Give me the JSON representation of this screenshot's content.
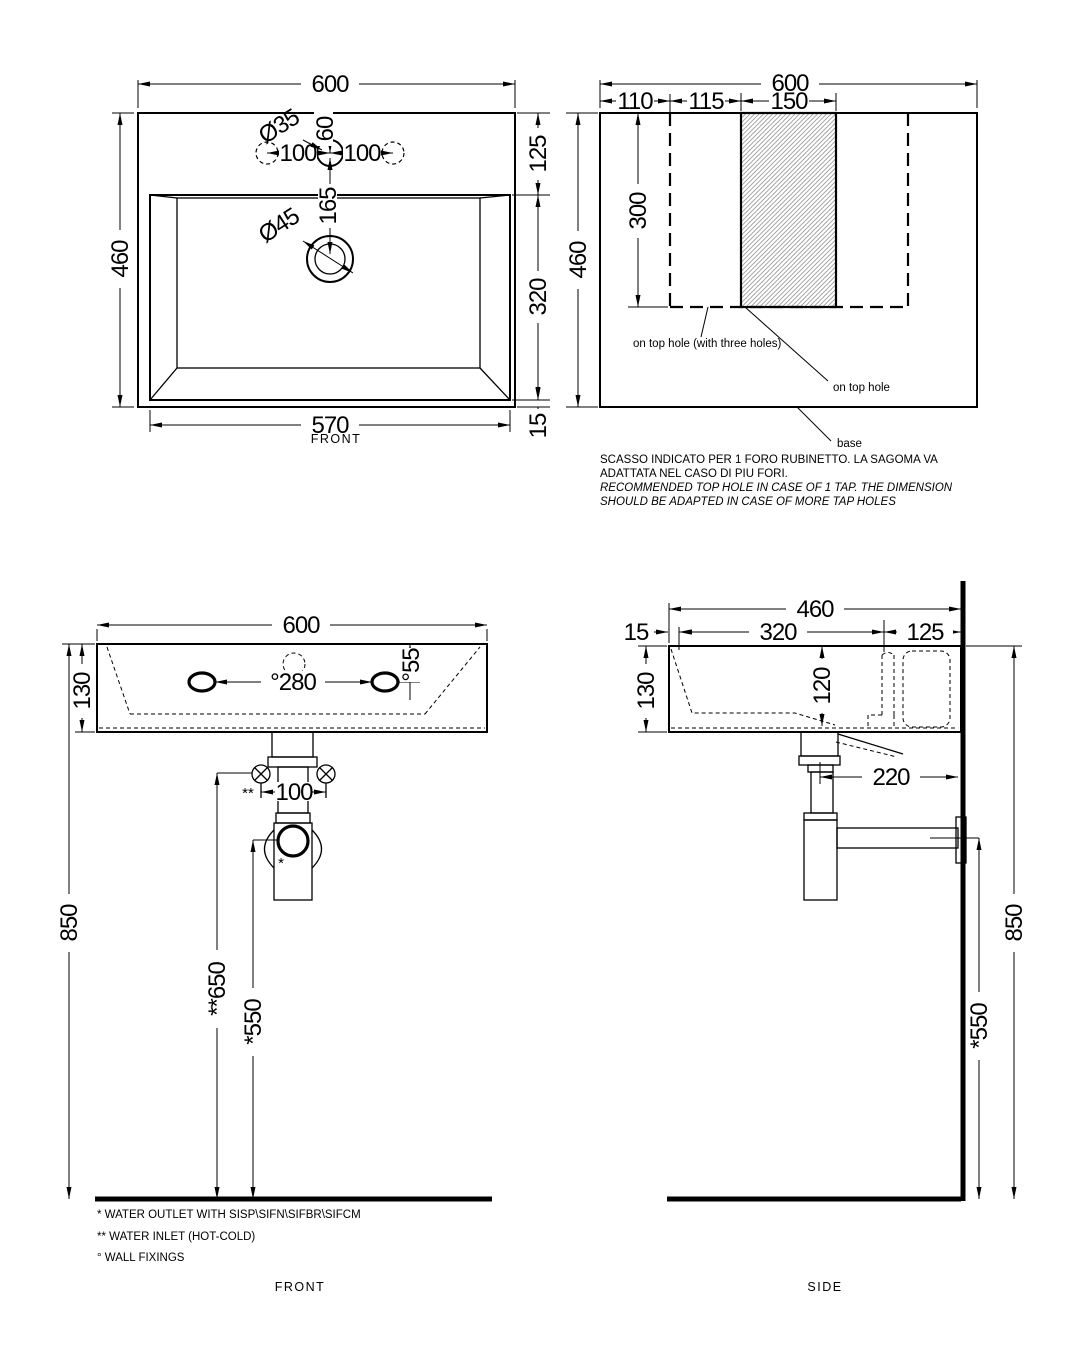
{
  "plan": {
    "dim_width": "600",
    "dim_height": "460",
    "dim_inner_width": "570",
    "dim_right_top": "125",
    "dim_right_mid": "320",
    "dim_right_bottom": "15",
    "dim_tap_offset": "60",
    "dim_tap_drain": "165",
    "dim_tap_spacing_left": "100",
    "dim_tap_spacing_right": "100",
    "label_tap_diameter": "Ø35",
    "label_drain_diameter": "Ø45",
    "caption": "FRONT"
  },
  "template": {
    "dim_width": "600",
    "dim_left": "110",
    "dim_mid": "115",
    "dim_hole": "150",
    "dim_height": "460",
    "dim_cutout_height": "300",
    "label_three_holes": "on top hole (with three holes)",
    "label_one_hole": "on top hole",
    "label_base": "base",
    "notes": [
      "SCASSO INDICATO PER 1 FORO RUBINETTO. LA SAGOMA VA",
      "ADATTATA NEL CASO DI PIU FORI.",
      "RECOMMENDED TOP HOLE IN CASE OF 1 TAP. THE DIMENSION",
      "SHOULD BE ADAPTED IN CASE OF MORE TAP HOLES"
    ]
  },
  "front": {
    "dim_width": "600",
    "dim_height": "130",
    "dim_fixing_spacing": "°280",
    "dim_fixing_depth": "°55",
    "dim_inlet_spacing": "100",
    "marker_inlet": "**",
    "marker_outlet": "*",
    "dim_total_height": "850",
    "dim_inlet_height": "**650",
    "dim_outlet_height": "*550",
    "caption": "FRONT",
    "notes": [
      "*  WATER OUTLET WITH SISP\\SIFN\\SIFBR\\SIFCM",
      "** WATER INLET  (HOT-COLD)",
      "°  WALL FIXINGS"
    ]
  },
  "side": {
    "dim_depth": "460",
    "dim_front_rim": "15",
    "dim_bowl": "320",
    "dim_back": "125",
    "dim_height": "130",
    "dim_bowl_depth": "120",
    "dim_outlet_wall": "220",
    "dim_total_height": "850",
    "dim_outlet_height": "*550",
    "caption": "SIDE"
  }
}
